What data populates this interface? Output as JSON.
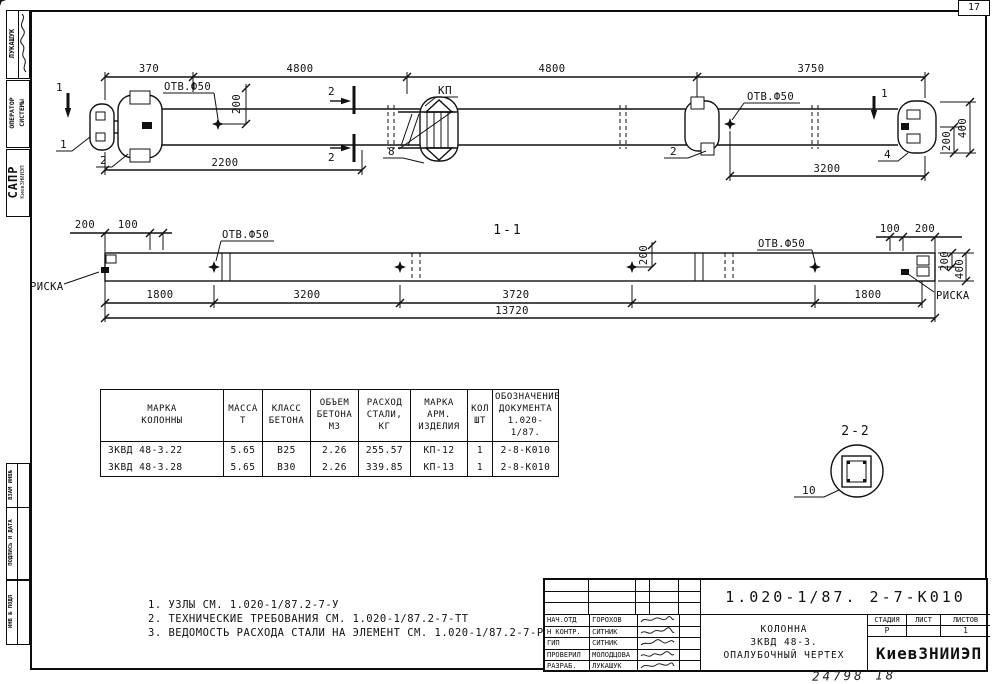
{
  "sheet": {
    "page_number": "17",
    "footer_note": "24798 18"
  },
  "margin_stamps": {
    "top_author": "ЛУКАШУК",
    "top_operator_line1": "ОПЕРАТОР",
    "top_operator_line2": "СИСТЕМЫ",
    "top_org_line1": "САПР",
    "top_org_line2": "КиевЗНИИЭП",
    "bottom": [
      "ВЗАМ ИНВ№",
      "ПОДПИСЬ И ДАТА",
      "ИНВ № ПОДЛ"
    ]
  },
  "elevation": {
    "dims_top": [
      "370",
      "4800",
      "4800",
      "3750"
    ],
    "dim_2200": "2200",
    "dim_3200": "3200",
    "hole_label_left": "ОТВ.Ф50",
    "hole_label_right": "ОТВ.Ф50",
    "dim_200_hole": "200",
    "dim_400_end": "400",
    "dim_200_end": "200",
    "console_label": "КП",
    "section_mark_1_left": "1",
    "section_mark_1_right": "1",
    "section_mark_2_top": "2",
    "section_mark_2_bottom": "2",
    "node_1": "1",
    "node_2_left": "2",
    "node_8": "8",
    "node_2_mid": "2",
    "node_4": "4"
  },
  "section_1_1": {
    "title": "1-1",
    "hole_label_left": "ОТВ.Ф50",
    "hole_label_right": "ОТВ.Ф50",
    "riska_left": "РИСКА",
    "riska_right": "РИСКА",
    "dim_200_tl": "200",
    "dim_100_tl": "100",
    "dim_100_tr": "100",
    "dim_200_tr": "200",
    "dim_200_mid": "200",
    "dim_200_end": "200",
    "dim_400_end": "400",
    "dims_bottom": [
      "1800",
      "3200",
      "3720",
      "1800"
    ],
    "dim_total": "13720"
  },
  "section_2_2": {
    "title": "2-2",
    "node_10": "10"
  },
  "spec_table": {
    "headers": [
      "МАРКА\nКОЛОННЫ",
      "МАССА\nТ",
      "КЛАСС\nБЕТОНА",
      "ОБЪЕМ\nБЕТОНА\nМ3",
      "РАСХОД\nСТАЛИ,\nКГ",
      "МАРКА\nАРМ.\nИЗДЕЛИЯ",
      "КОЛ\nШТ",
      "ОБОЗНАЧЕНИЕ\nДОКУМЕНТА\n1.020-1/87."
    ],
    "rows": [
      [
        "ЗКВД 48-3.22",
        "5.65",
        "В25",
        "2.26",
        "255.57",
        "КП-12",
        "1",
        "2-8-К010"
      ],
      [
        "ЗКВД 48-3.28",
        "5.65",
        "В30",
        "2.26",
        "339.85",
        "КП-13",
        "1",
        "2-8-К010"
      ]
    ]
  },
  "notes": [
    "1. УЗЛЫ СМ. 1.020-1/87.2-7-У",
    "2. ТЕХНИЧЕСКИЕ ТРЕБОВАНИЯ СМ. 1.020-1/87.2-7-ТТ",
    "3. ВЕДОМОСТЬ РАСХОДА СТАЛИ НА ЭЛЕМЕНТ СМ. 1.020-1/87.2-7-РС"
  ],
  "title_block": {
    "doc_number": "1.020-1/87. 2-7-К010",
    "signature_rows": [
      {
        "role": "НАЧ.ОТД",
        "name": "ГОРОХОВ"
      },
      {
        "role": "Н КОНТР.",
        "name": "СИТНИК"
      },
      {
        "role": "ГИП",
        "name": "СИТНИК"
      },
      {
        "role": "ПРОВЕРИЛ",
        "name": "МОЛОДЦОВА"
      },
      {
        "role": "РАЗРАБ.",
        "name": "ЛУКАШУК"
      }
    ],
    "subject": [
      "КОЛОННА",
      "ЗКВД 48-3.",
      "ОПАЛУБОЧНЫЙ ЧЕРТЕХ"
    ],
    "stage_label": "СТАДИЯ",
    "sheet_label": "ЛИСТ",
    "sheets_label": "ЛИСТОВ",
    "stage_value": "Р",
    "sheet_value": "",
    "sheets_value": "1",
    "organization": "КиевЗНИИЭП"
  }
}
